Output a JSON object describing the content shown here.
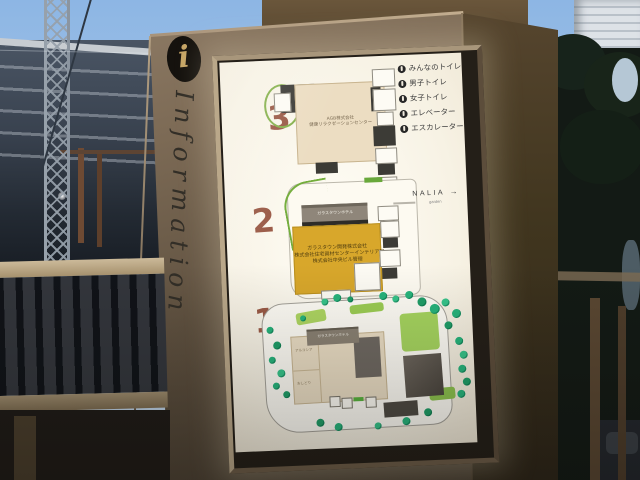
{
  "palette": {
    "sign_bronze": "#76654f",
    "panel_white": "#f8f4e8",
    "floor_number_red": "#9a5a46",
    "tenant_yellow": "#d8a72b",
    "map_beige": "#ecddc2",
    "tree_green": "#27b47c",
    "lawn_green": "#a8d45e",
    "sky_blue": "#8db6e4"
  },
  "sign": {
    "info_symbol": "i",
    "title_vertical": "Information",
    "legend": {
      "items": [
        {
          "icon": "accessible-toilet-icon",
          "label": "みんなのトイレ"
        },
        {
          "icon": "mens-toilet-icon",
          "label": "男子トイレ"
        },
        {
          "icon": "womens-toilet-icon",
          "label": "女子トイレ"
        },
        {
          "icon": "elevator-icon",
          "label": "エレベーター"
        },
        {
          "icon": "escalator-icon",
          "label": "エスカレーター"
        }
      ]
    },
    "wayfinding": {
      "label": "NALIA",
      "sublabel": "garden",
      "arrow": "→"
    },
    "floors": [
      {
        "number": "3",
        "tenant_lines": [
          "AGB株式会社",
          "健康リラクゼーションセンター"
        ]
      },
      {
        "number": "2",
        "building_label": "ガラスタウンホテル",
        "tenant_lines": [
          "ガラスタウン開発株式会社",
          "株式会社住宅資材センターインテリア部",
          "株式会社中央ビル管理"
        ]
      },
      {
        "number": "1",
        "building_label": "ガラスタウンホテル",
        "room_labels": [
          "アルコシア",
          "おしどり"
        ]
      }
    ]
  }
}
